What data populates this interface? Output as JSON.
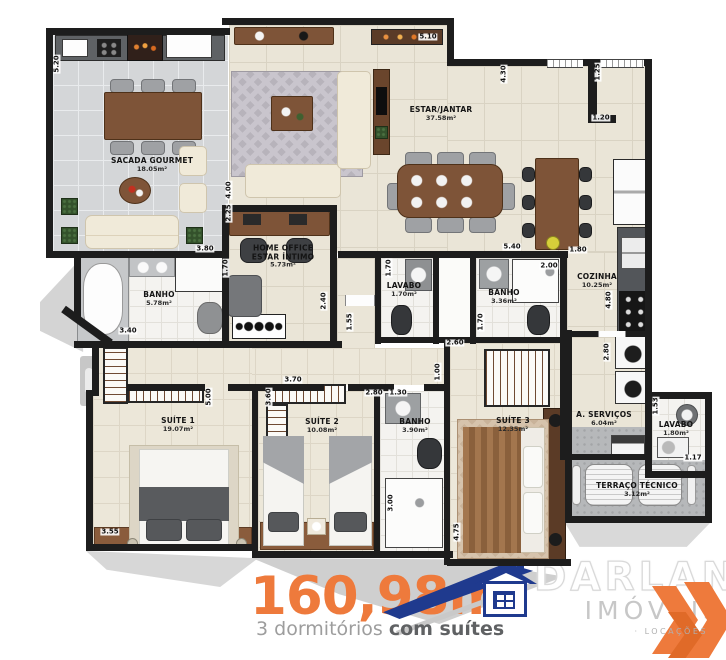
{
  "plan": {
    "rooms": [
      {
        "slug": "sacada-gourmet",
        "name": "SACADA GOURMET",
        "area": "18.05m²",
        "x": 152,
        "y": 165
      },
      {
        "slug": "estar-jantar",
        "name": "ESTAR/JANTAR",
        "area": "37.58m²",
        "x": 441,
        "y": 114
      },
      {
        "slug": "home-office",
        "name": "HOME OFFICE",
        "name2": "ESTAR ÍNTIMO",
        "area": "5.73m²",
        "x": 283,
        "y": 257
      },
      {
        "slug": "banho-suite1",
        "name": "BANHO",
        "area": "5.78m²",
        "x": 159,
        "y": 299
      },
      {
        "slug": "lavabo-1",
        "name": "LAVABO",
        "area": "1.70m²",
        "x": 404,
        "y": 290
      },
      {
        "slug": "banho-social",
        "name": "BANHO",
        "area": "3.36m²",
        "x": 504,
        "y": 297
      },
      {
        "slug": "cozinha",
        "name": "COZINHA",
        "area": "10.25m²",
        "x": 597,
        "y": 281
      },
      {
        "slug": "area-servicos",
        "name": "A. SERVIÇOS",
        "area": "6.04m²",
        "x": 604,
        "y": 419
      },
      {
        "slug": "lavabo-2",
        "name": "LAVABO",
        "area": "1.80m²",
        "x": 676,
        "y": 429
      },
      {
        "slug": "terraco-tecnico",
        "name": "TERRAÇO TÉCNICO",
        "area": "3.12m²",
        "x": 637,
        "y": 490
      },
      {
        "slug": "suite-1",
        "name": "SUÍTE 1",
        "area": "19.07m²",
        "x": 178,
        "y": 425
      },
      {
        "slug": "suite-2",
        "name": "SUÍTE 2",
        "area": "10.08m²",
        "x": 322,
        "y": 426
      },
      {
        "slug": "banho-suite2",
        "name": "BANHO",
        "area": "3.90m²",
        "x": 415,
        "y": 426
      },
      {
        "slug": "suite-3",
        "name": "SUÍTE 3",
        "area": "12.35m²",
        "x": 513,
        "y": 425
      }
    ],
    "dims": [
      {
        "t": "5.20",
        "x": 57,
        "y": 64,
        "v": true
      },
      {
        "t": "3.80",
        "x": 205,
        "y": 249,
        "v": false
      },
      {
        "t": "4.00",
        "x": 229,
        "y": 190,
        "v": true
      },
      {
        "t": "2.25",
        "x": 229,
        "y": 213,
        "v": true
      },
      {
        "t": "1.70",
        "x": 226,
        "y": 268,
        "v": true
      },
      {
        "t": "2.40",
        "x": 324,
        "y": 301,
        "v": true
      },
      {
        "t": "1.55",
        "x": 350,
        "y": 322,
        "v": true
      },
      {
        "t": "3.40",
        "x": 128,
        "y": 331,
        "v": false
      },
      {
        "t": "5.10",
        "x": 428,
        "y": 37,
        "v": false
      },
      {
        "t": "4.30",
        "x": 504,
        "y": 74,
        "v": true
      },
      {
        "t": "1.25",
        "x": 598,
        "y": 72,
        "v": true
      },
      {
        "t": "1.20",
        "x": 601,
        "y": 118,
        "v": false
      },
      {
        "t": "5.40",
        "x": 512,
        "y": 247,
        "v": false
      },
      {
        "t": "1.80",
        "x": 578,
        "y": 250,
        "v": false
      },
      {
        "t": "2.00",
        "x": 549,
        "y": 266,
        "v": false
      },
      {
        "t": "1.70",
        "x": 389,
        "y": 268,
        "v": true
      },
      {
        "t": "1.70",
        "x": 481,
        "y": 322,
        "v": true
      },
      {
        "t": "2.60",
        "x": 455,
        "y": 343,
        "v": false
      },
      {
        "t": "1.00",
        "x": 438,
        "y": 372,
        "v": true
      },
      {
        "t": "3.70",
        "x": 293,
        "y": 380,
        "v": false
      },
      {
        "t": "3.60",
        "x": 269,
        "y": 397,
        "v": true
      },
      {
        "t": "5.00",
        "x": 209,
        "y": 397,
        "v": true
      },
      {
        "t": "3.55",
        "x": 110,
        "y": 532,
        "v": false
      },
      {
        "t": "2.80",
        "x": 374,
        "y": 393,
        "v": false
      },
      {
        "t": "1.30",
        "x": 398,
        "y": 393,
        "v": false
      },
      {
        "t": "3.00",
        "x": 391,
        "y": 503,
        "v": true
      },
      {
        "t": "4.75",
        "x": 457,
        "y": 532,
        "v": true
      },
      {
        "t": "4.80",
        "x": 609,
        "y": 300,
        "v": true
      },
      {
        "t": "2.80",
        "x": 607,
        "y": 352,
        "v": true
      },
      {
        "t": "1.53",
        "x": 656,
        "y": 406,
        "v": true
      },
      {
        "t": "1.17",
        "x": 693,
        "y": 458,
        "v": false
      }
    ]
  },
  "footer": {
    "area_total": "160,98m²",
    "subtitle_prefix": "3 dormitórios ",
    "subtitle_bold": "com suítes",
    "brand": "DARLAN",
    "brand_sub": "IMÓVEIS",
    "tagline": "· LOCAÇÕES",
    "accent_orange": "#ee7a3c",
    "brand_blue": "#1f3a8e"
  }
}
